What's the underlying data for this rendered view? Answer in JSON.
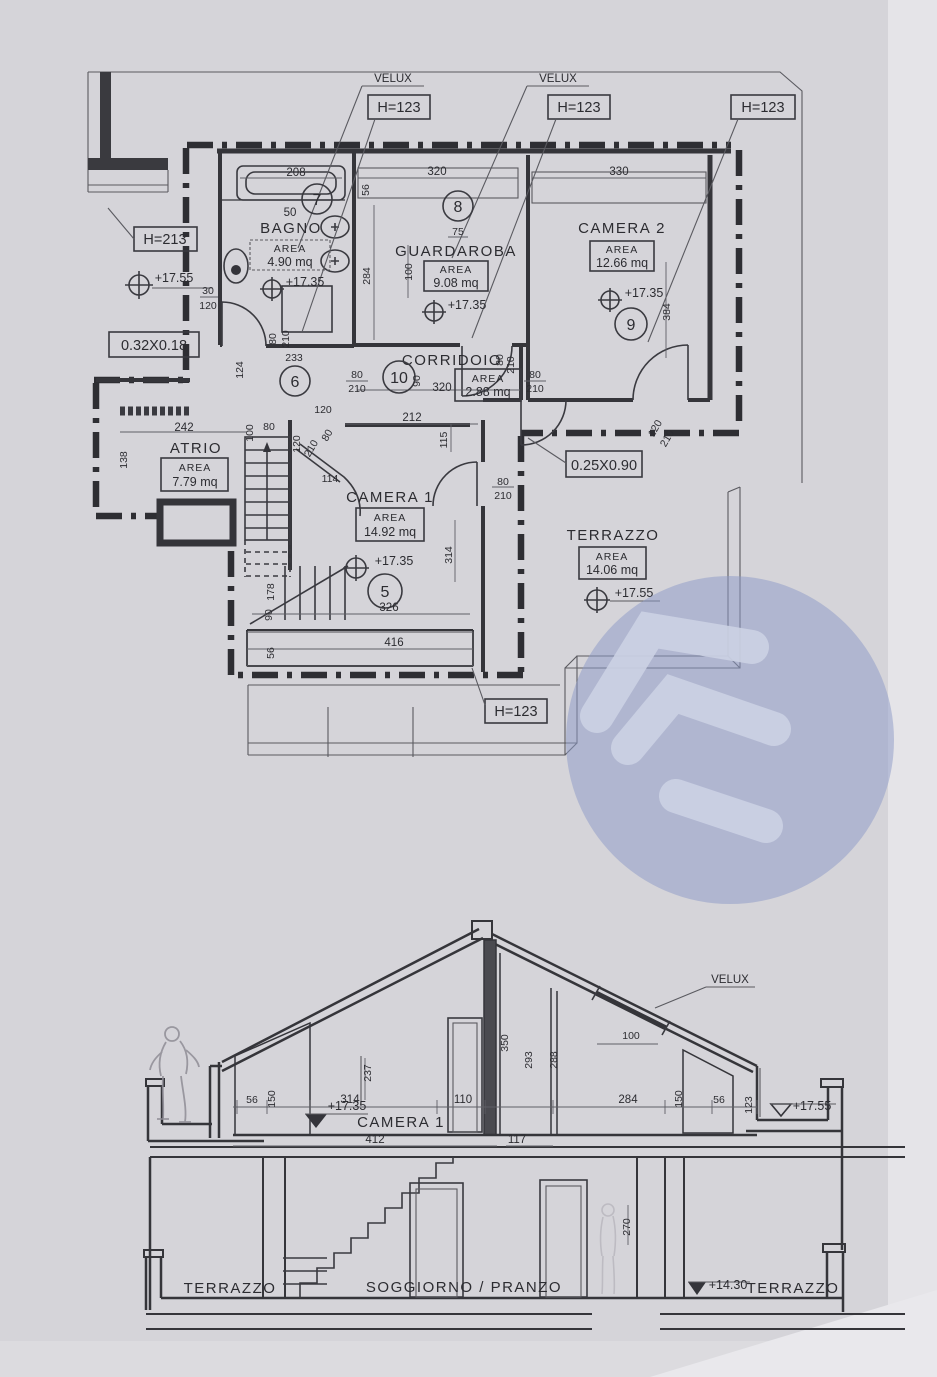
{
  "colors": {
    "paper": "#d5d4d9",
    "ink": "#323237",
    "watermark_blue": "#8d9bc7"
  },
  "plan": {
    "skylight_label_1": "VELUX",
    "skylight_label_2": "VELUX",
    "badge_h123_1": "H=123",
    "badge_h123_2": "H=123",
    "badge_h123_3": "H=123",
    "badge_h123_4": "H=123",
    "badge_h213": "H=213",
    "badge_win_1": "0.32X0.18",
    "badge_win_2": "0.25X0.90",
    "level_left": "+17.55",
    "rooms": {
      "bagno": {
        "name": "BAGNO",
        "area_label": "AREA",
        "area": "4.90 mq",
        "num": "7",
        "level": "+17.35"
      },
      "guardaroba": {
        "name": "GUARDAROBA",
        "area_label": "AREA",
        "area": "9.08 mq",
        "num": "8",
        "level": "+17.35"
      },
      "camera2": {
        "name": "CAMERA 2",
        "area_label": "AREA",
        "area": "12.66 mq",
        "num": "9",
        "level": "+17.35"
      },
      "corridoio": {
        "name": "CORRIDOIO",
        "area_label": "AREA",
        "area": "2.88 mq",
        "num": "10"
      },
      "atrio": {
        "name": "ATRIO",
        "area_label": "AREA",
        "area": "7.79 mq",
        "num": "6"
      },
      "camera1": {
        "name": "CAMERA 1",
        "area_label": "AREA",
        "area": "14.92 mq",
        "num": "5",
        "level": "+17.35"
      },
      "terrazzo": {
        "name": "TERRAZZO",
        "area_label": "AREA",
        "area": "14.06 mq",
        "level": "+17.55"
      }
    },
    "dims": {
      "tub": "208",
      "d50": "50",
      "g56": "56",
      "g320": "320",
      "g75": "75",
      "g100": "100",
      "g284": "284",
      "c2_330": "330",
      "c2_384": "384",
      "c2_120": "120",
      "c2_210": "210",
      "b30": "30",
      "b120": "120",
      "b80": "80",
      "b210": "210",
      "b233": "233",
      "b124": "124",
      "co80l": "80",
      "co210l": "210",
      "co90": "90",
      "co320": "320",
      "co80r": "80",
      "co210r": "210",
      "co80h": "80",
      "co210h": "210",
      "co212": "212",
      "co115": "115",
      "a242": "242",
      "a138": "138",
      "a100": "100",
      "a80": "80",
      "a120v": "120",
      "a120h": "120",
      "a210": "210",
      "a80r": "80",
      "a114": "114",
      "c1_178": "178",
      "c1_90": "90",
      "c1_56": "56",
      "c1_326": "326",
      "c1_416": "416",
      "c1_314": "314",
      "c1_80": "80",
      "c1_210": "210"
    }
  },
  "section": {
    "skylight_label": "VELUX",
    "room_camera1": "CAMERA 1",
    "room_terrazzo_left": "TERRAZZO",
    "room_soggiorno": "SOGGIORNO / PRANZO",
    "room_terrazzo_right": "TERRAZZO",
    "level_camera1": "+17.35",
    "level_terrace_right": "+17.55",
    "level_lower_terrace": "+14.30",
    "dims": {
      "l56": "56",
      "l150": "150",
      "c314": "314",
      "c237": "237",
      "c110": "110",
      "w350": "350",
      "w293": "293",
      "r288": "288",
      "sky100": "100",
      "r284": "284",
      "r150": "150",
      "r56": "56",
      "r123": "123",
      "f412": "412",
      "f117": "117",
      "low270": "270"
    }
  }
}
